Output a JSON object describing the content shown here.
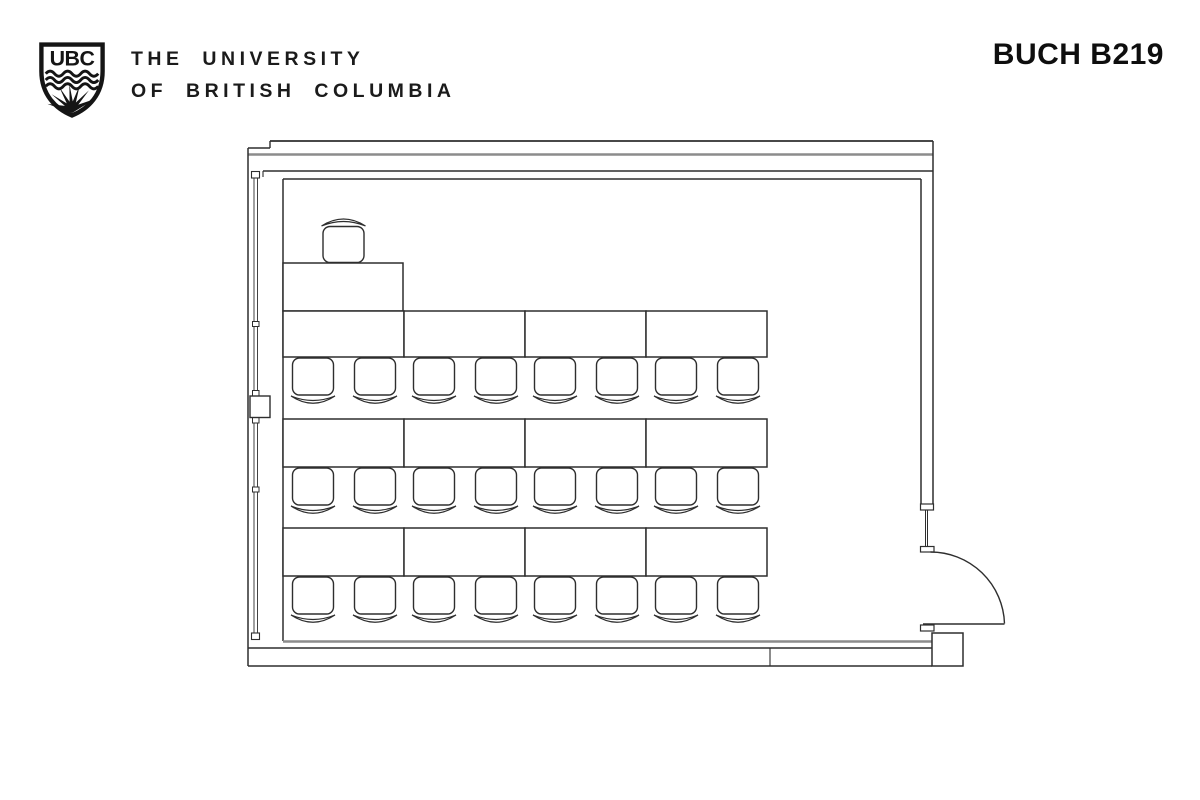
{
  "header": {
    "crest_monogram": "UBC",
    "university_line1": "THE UNIVERSITY",
    "university_line2": "OF BRITISH COLUMBIA",
    "room_label": "BUCH B219"
  },
  "floor_plan": {
    "rows_of_tables": 3,
    "tables_per_row": 4,
    "chairs_per_table": 2,
    "student_chair_count": 24,
    "instructor_table_count": 1,
    "instructor_chair_count": 1,
    "door_corner": "bottom-right",
    "ink": "#2e2e2e",
    "muted_ink": "#8c8c8c"
  }
}
